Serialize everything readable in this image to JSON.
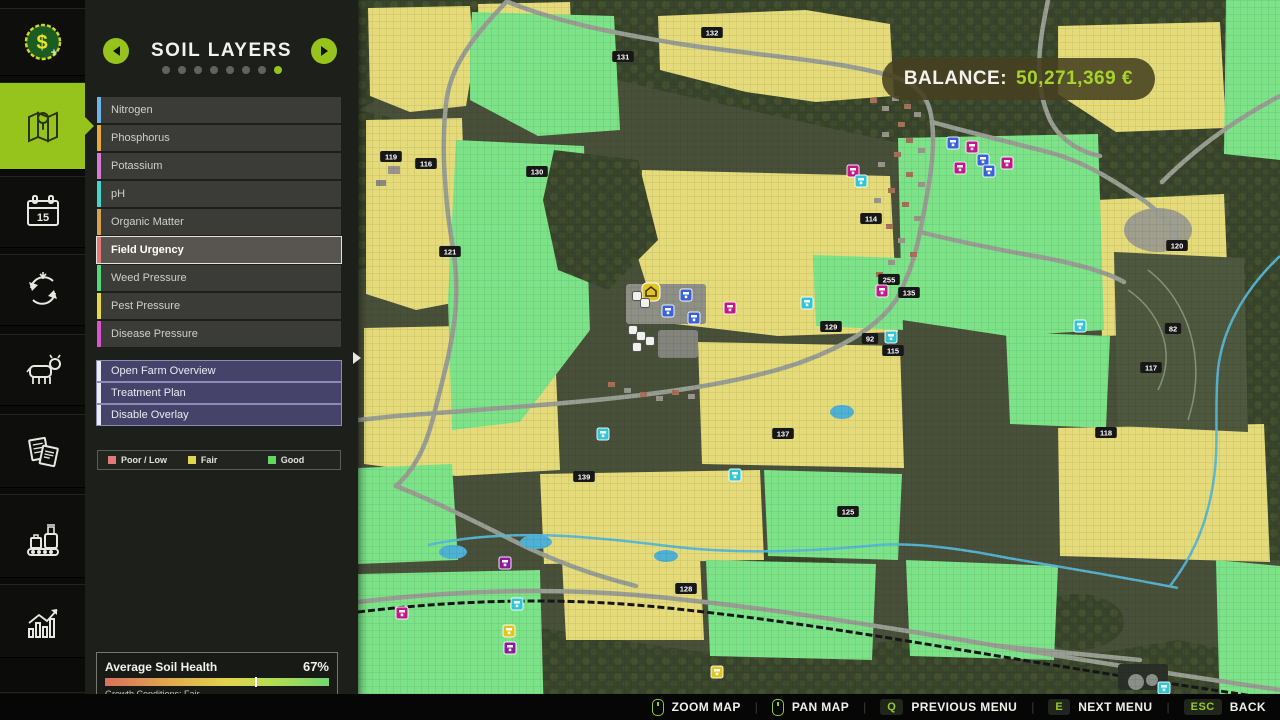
{
  "sidebar": {
    "items": [
      {
        "id": "finances",
        "icon": "money-icon",
        "active": false
      },
      {
        "id": "map",
        "icon": "map-icon",
        "active": true
      },
      {
        "id": "calendar",
        "icon": "calendar-icon",
        "active": false,
        "calendar_day": "15"
      },
      {
        "id": "crop-rotation",
        "icon": "crop-rotation-icon",
        "active": false
      },
      {
        "id": "animals",
        "icon": "cow-icon",
        "active": false
      },
      {
        "id": "contracts",
        "icon": "contracts-icon",
        "active": false
      },
      {
        "id": "production",
        "icon": "production-icon",
        "active": false
      },
      {
        "id": "statistics",
        "icon": "statistics-icon",
        "active": false
      },
      {
        "id": "more",
        "icon": "partial-icon",
        "active": false
      }
    ]
  },
  "panel": {
    "title": "SOIL LAYERS",
    "page_dots": {
      "count": 8,
      "active_index": 7
    },
    "layers": [
      {
        "label": "Nitrogen",
        "color": "#6cb6e8",
        "selected": false
      },
      {
        "label": "Phosphorus",
        "color": "#e8aa3c",
        "selected": false
      },
      {
        "label": "Potassium",
        "color": "#d87ad8",
        "selected": false
      },
      {
        "label": "pH",
        "color": "#44d8cc",
        "selected": false
      },
      {
        "label": "Organic Matter",
        "color": "#d8a050",
        "selected": false
      },
      {
        "label": "Field Urgency",
        "color": "#e87878",
        "selected": true
      },
      {
        "label": "Weed Pressure",
        "color": "#55d877",
        "selected": false
      },
      {
        "label": "Pest Pressure",
        "color": "#e8d846",
        "selected": false
      },
      {
        "label": "Disease Pressure",
        "color": "#d855cc",
        "selected": false
      }
    ],
    "actions": [
      "Open Farm Overview",
      "Treatment Plan",
      "Disable Overlay"
    ],
    "legend": [
      {
        "label": "Poor / Low",
        "color": "#e07a72"
      },
      {
        "label": "Fair",
        "color": "#e2d44e"
      },
      {
        "label": "Good",
        "color": "#62d862"
      }
    ],
    "health": {
      "title": "Average Soil Health",
      "value": "67%",
      "percent": 67,
      "subtitle": "Growth Conditions: Fair"
    }
  },
  "hud": {
    "balance_label": "BALANCE:",
    "balance_value": "50,271,369 €"
  },
  "bottom_bar": {
    "controls": [
      {
        "icon": "mouse",
        "label": "ZOOM MAP"
      },
      {
        "icon": "mouse",
        "label": "PAN MAP"
      },
      {
        "key": "Q",
        "label": "PREVIOUS MENU"
      },
      {
        "key": "E",
        "label": "NEXT MENU"
      },
      {
        "key": "ESC",
        "label": "BACK"
      }
    ]
  },
  "map": {
    "colors": {
      "fair": "#e5db7a",
      "good": "#7de389",
      "forest": "#39452d",
      "road": "#999e93",
      "water": "#57b6d6"
    },
    "field_labels": [
      {
        "n": "132",
        "x": 354,
        "y": 33
      },
      {
        "n": "131",
        "x": 265,
        "y": 57
      },
      {
        "n": "119",
        "x": 33,
        "y": 157
      },
      {
        "n": "116",
        "x": 68,
        "y": 164
      },
      {
        "n": "130",
        "x": 179,
        "y": 172
      },
      {
        "n": "121",
        "x": 92,
        "y": 252
      },
      {
        "n": "114",
        "x": 513,
        "y": 219
      },
      {
        "n": "255",
        "x": 531,
        "y": 280
      },
      {
        "n": "135",
        "x": 551,
        "y": 293
      },
      {
        "n": "129",
        "x": 473,
        "y": 327
      },
      {
        "n": "92",
        "x": 512,
        "y": 339
      },
      {
        "n": "115",
        "x": 535,
        "y": 351
      },
      {
        "n": "120",
        "x": 819,
        "y": 246
      },
      {
        "n": "82",
        "x": 815,
        "y": 329
      },
      {
        "n": "117",
        "x": 793,
        "y": 368
      },
      {
        "n": "118",
        "x": 748,
        "y": 433
      },
      {
        "n": "137",
        "x": 425,
        "y": 434
      },
      {
        "n": "139",
        "x": 226,
        "y": 477
      },
      {
        "n": "125",
        "x": 490,
        "y": 512
      },
      {
        "n": "128",
        "x": 328,
        "y": 589
      }
    ],
    "pois": [
      {
        "c": "blue",
        "x": 595,
        "y": 143
      },
      {
        "c": "blue",
        "x": 625,
        "y": 160
      },
      {
        "c": "blue",
        "x": 631,
        "y": 171
      },
      {
        "c": "blue",
        "x": 328,
        "y": 295
      },
      {
        "c": "blue",
        "x": 310,
        "y": 311
      },
      {
        "c": "blue",
        "x": 336,
        "y": 318
      },
      {
        "c": "magenta",
        "x": 614,
        "y": 147
      },
      {
        "c": "magenta",
        "x": 602,
        "y": 168
      },
      {
        "c": "magenta",
        "x": 649,
        "y": 163
      },
      {
        "c": "magenta",
        "x": 495,
        "y": 171
      },
      {
        "c": "magenta",
        "x": 524,
        "y": 291
      },
      {
        "c": "magenta",
        "x": 372,
        "y": 308
      },
      {
        "c": "magenta",
        "x": 44,
        "y": 613
      },
      {
        "c": "cyan",
        "x": 503,
        "y": 181
      },
      {
        "c": "cyan",
        "x": 533,
        "y": 337
      },
      {
        "c": "cyan",
        "x": 449,
        "y": 303
      },
      {
        "c": "cyan",
        "x": 722,
        "y": 326
      },
      {
        "c": "cyan",
        "x": 245,
        "y": 434
      },
      {
        "c": "cyan",
        "x": 377,
        "y": 475
      },
      {
        "c": "cyan",
        "x": 159,
        "y": 604
      },
      {
        "c": "cyan",
        "x": 806,
        "y": 688
      },
      {
        "c": "farm",
        "x": 293,
        "y": 292
      },
      {
        "c": "yellow",
        "x": 151,
        "y": 631
      },
      {
        "c": "yellow",
        "x": 359,
        "y": 672
      },
      {
        "c": "purple",
        "x": 147,
        "y": 563
      },
      {
        "c": "purple",
        "x": 152,
        "y": 648
      },
      {
        "c": "white",
        "x": 279,
        "y": 296
      },
      {
        "c": "white",
        "x": 287,
        "y": 303
      },
      {
        "c": "white",
        "x": 275,
        "y": 330
      },
      {
        "c": "white",
        "x": 283,
        "y": 336
      },
      {
        "c": "white",
        "x": 292,
        "y": 341
      },
      {
        "c": "white",
        "x": 279,
        "y": 347
      }
    ]
  }
}
